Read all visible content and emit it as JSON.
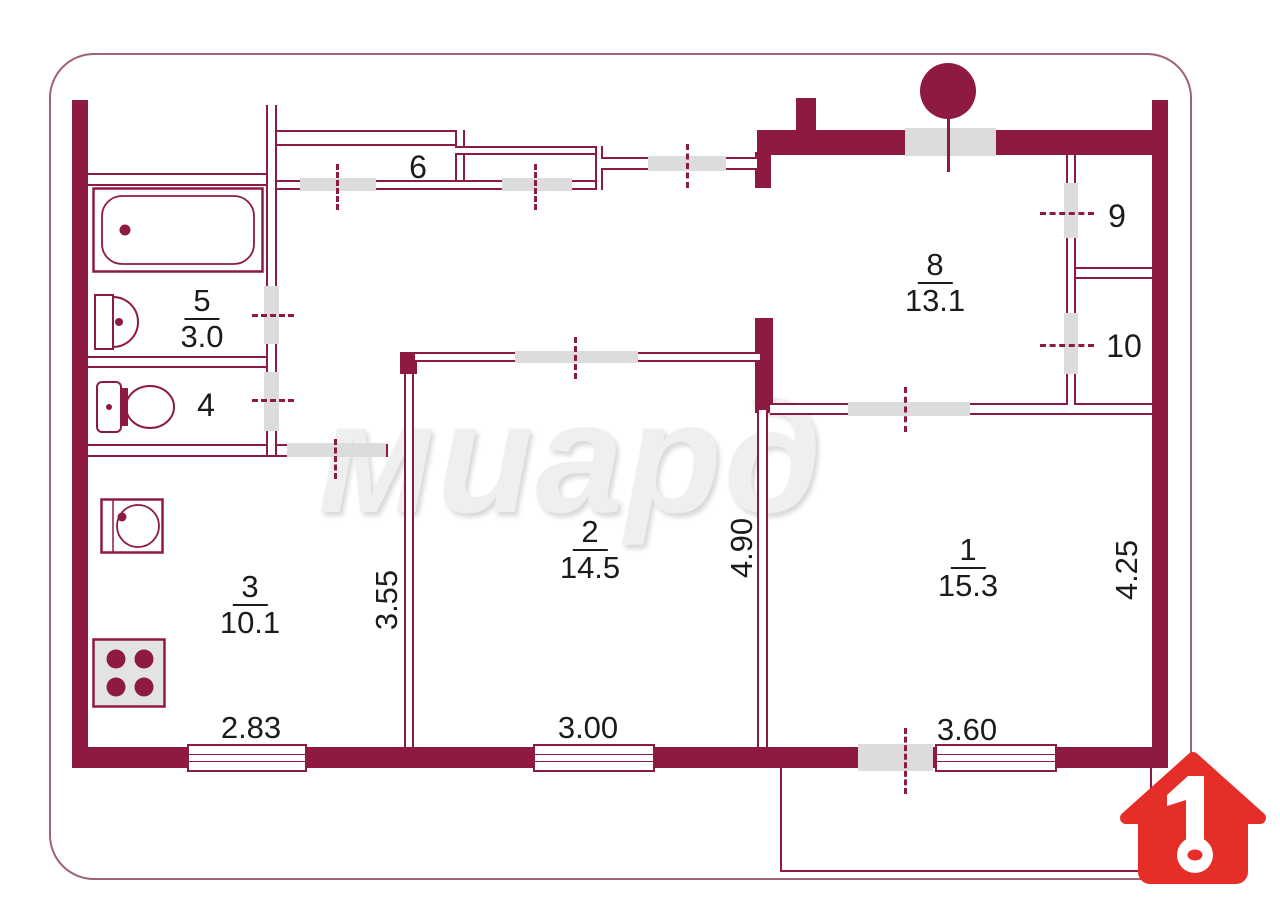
{
  "plan": {
    "watermark": "миард",
    "rooms": [
      {
        "id": "bathroom",
        "number": "5",
        "area": "3.0"
      },
      {
        "id": "wc",
        "number": "4"
      },
      {
        "id": "closet",
        "number": "6"
      },
      {
        "id": "living-8",
        "number": "8",
        "area": "13.1"
      },
      {
        "id": "storage-9",
        "number": "9"
      },
      {
        "id": "storage-10",
        "number": "10"
      },
      {
        "id": "room-2",
        "number": "2",
        "area": "14.5"
      },
      {
        "id": "room-1",
        "number": "1",
        "area": "15.3"
      },
      {
        "id": "kitchen-3",
        "number": "3",
        "area": "10.1"
      }
    ],
    "dimensions": {
      "kitchen_window": "2.83",
      "room2_window": "3.00",
      "room1_window": "3.60",
      "kitchen_width": "3.55",
      "room2_depth": "4.90",
      "room1_depth": "4.25"
    },
    "logo_number": "1",
    "colors": {
      "wall": "#8e1a43",
      "opening": "#dcdcdc",
      "logo": "#e62e28",
      "watermark": "#efefef"
    }
  }
}
